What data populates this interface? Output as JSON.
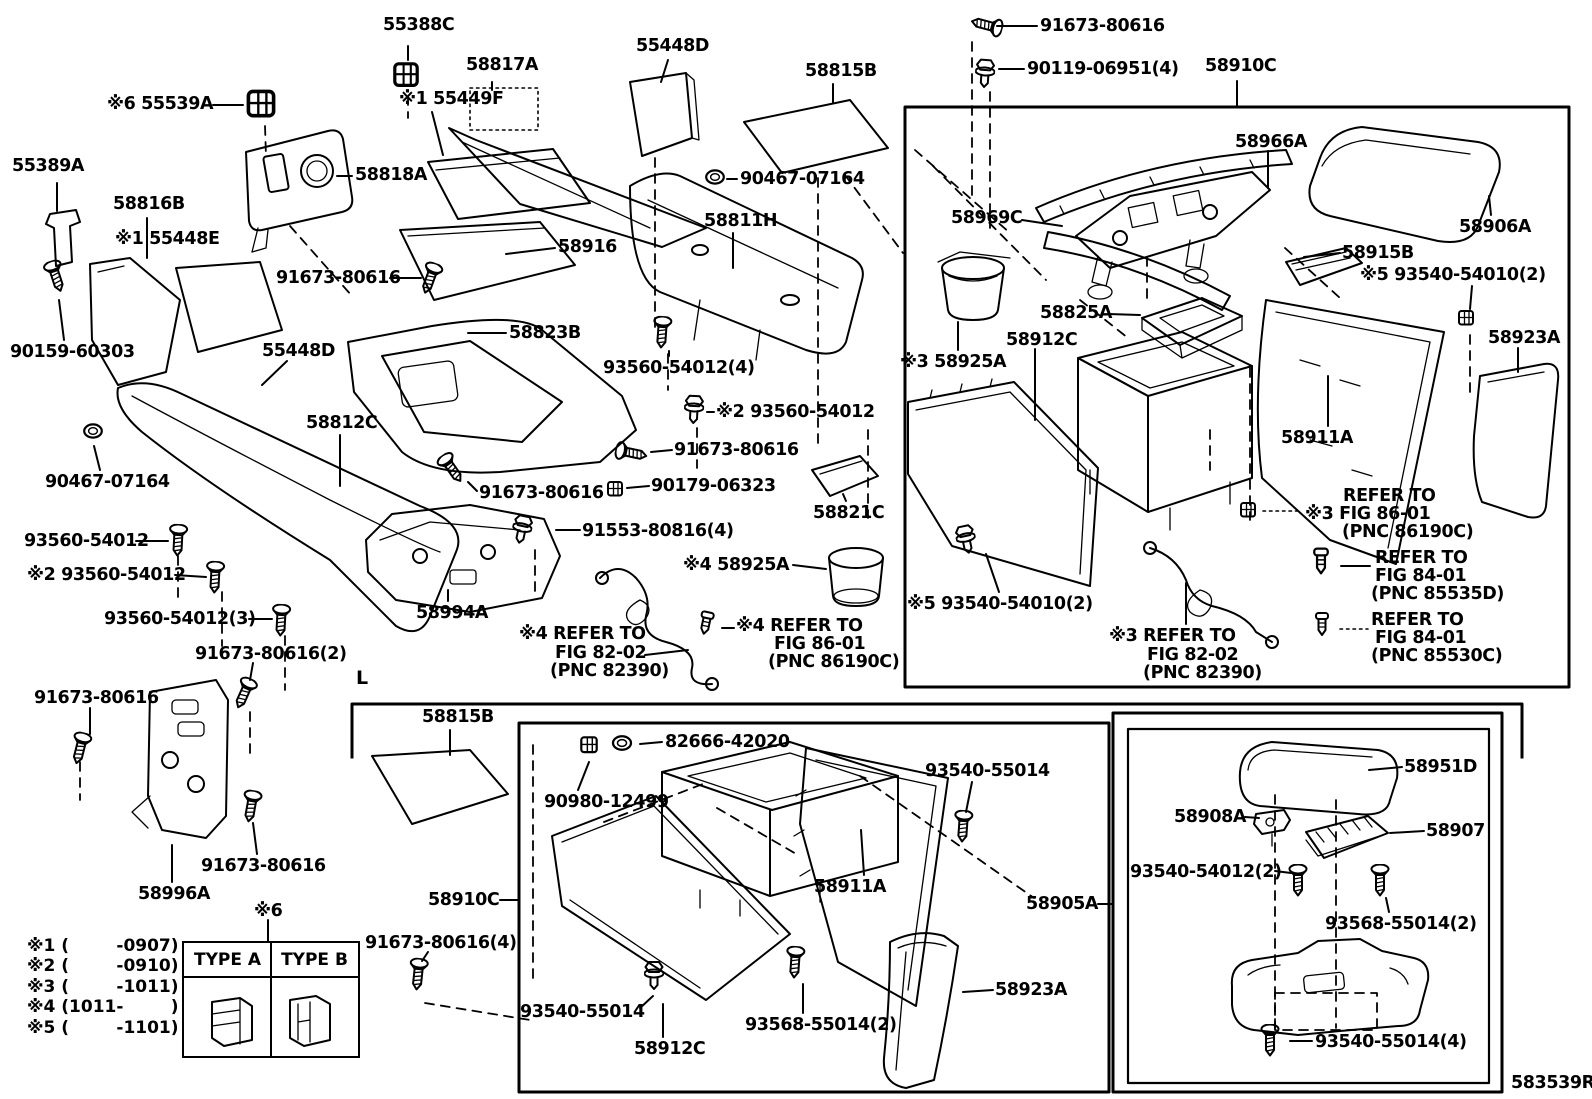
{
  "figure_code": "583539R",
  "section_marker": "L",
  "type_table": {
    "col_a": "TYPE A",
    "col_b": "TYPE B"
  },
  "legend": {
    "rows": [
      "※1 (        -0907)",
      "※2 (        -0910)",
      "※3 (        -1011)",
      "※4 (1011-        )",
      "※5 (        -1101)"
    ]
  },
  "labels": {
    "a55388c": "55388C",
    "a58817a": "58817A",
    "a55449f": "※1 55449F",
    "a55539a": "※6 55539A",
    "a55389a": "55389A",
    "a58816b": "58816B",
    "a55448e": "※1 55448E",
    "a58818a": "58818A",
    "a55448d_top": "55448D",
    "a58815b_top": "58815B",
    "a91673_tr": "91673-80616",
    "a90119": "90119-06951(4)",
    "a58910c_top": "58910C",
    "a90467_top": "90467-07164",
    "a58811h": "58811H",
    "a58916": "58916",
    "a91673_l1": "91673-80616",
    "a90159": "90159-60303",
    "a55448d_mid": "55448D",
    "a58823b": "58823B",
    "a93560_4": "93560-54012(4)",
    "a93560_x2r": "※2 93560-54012",
    "a58812c": "58812C",
    "a91673_mid": "91673-80616",
    "a90467_bot": "90467-07164",
    "a91673_c": "91673-80616",
    "a90179": "90179-06323",
    "a93560_1": "93560-54012",
    "a91553": "91553-80816(4)",
    "a58821c": "58821C",
    "a93560_x2l": "※2 93560-54012",
    "a58925a_x4": "※4 58925A",
    "a93560_3": "93560-54012(3)",
    "a58994a": "58994A",
    "a91673_2": "91673-80616(2)",
    "ref82l_1": "※4 REFER TO",
    "ref82l_2": "FIG 82-02",
    "ref82l_3": "(PNC 82390)",
    "ref86l_1": "※4 REFER TO",
    "ref86l_2": "FIG 86-01",
    "ref86l_3": "(PNC 86190C)",
    "a91673_d": "91673-80616",
    "a91673_e": "91673-80616",
    "a58996a": "58996A",
    "x6": "※6",
    "a91673_4": "91673-80616(4)",
    "a58815b_bot": "58815B",
    "a58910c_bot": "58910C",
    "a90980": "90980-12499",
    "a82666": "82666-42020",
    "a93540_r": "93540-55014",
    "a58911a_bot": "58911A",
    "a58905a": "58905A",
    "a93540_l": "93540-55014",
    "a58912c_bot": "58912C",
    "a93568_bot": "93568-55014(2)",
    "a58923a_bot": "58923A",
    "a58951d": "58951D",
    "a58908a": "58908A",
    "a58907": "58907",
    "a93540_54012_2": "93540-54012(2)",
    "a93568_br": "93568-55014(2)",
    "a93540_4": "93540-55014(4)",
    "a58966a": "58966A",
    "a58969c": "58969C",
    "a58906a": "58906A",
    "a58915b": "58915B",
    "a93540_t": "※5 93540-54010(2)",
    "a58825a": "58825A",
    "a58912c_r": "58912C",
    "a58925a_x3": "※3 58925A",
    "a58923a_r": "58923A",
    "a58911a_r": "58911A",
    "ref86r_1": "REFER TO",
    "ref86r_2": "※3 FIG 86-01",
    "ref86r_3": "(PNC 86190C)",
    "ref84a_1": "REFER TO",
    "ref84a_2": "FIG 84-01",
    "ref84a_3": "(PNC 85535D)",
    "ref84b_1": "REFER TO",
    "ref84b_2": "FIG 84-01",
    "ref84b_3": "(PNC 85530C)",
    "a93540_b": "※5 93540-54010(2)",
    "ref82r_1": "※3 REFER TO",
    "ref82r_2": "FIG 82-02",
    "ref82r_3": "(PNC 82390)"
  }
}
